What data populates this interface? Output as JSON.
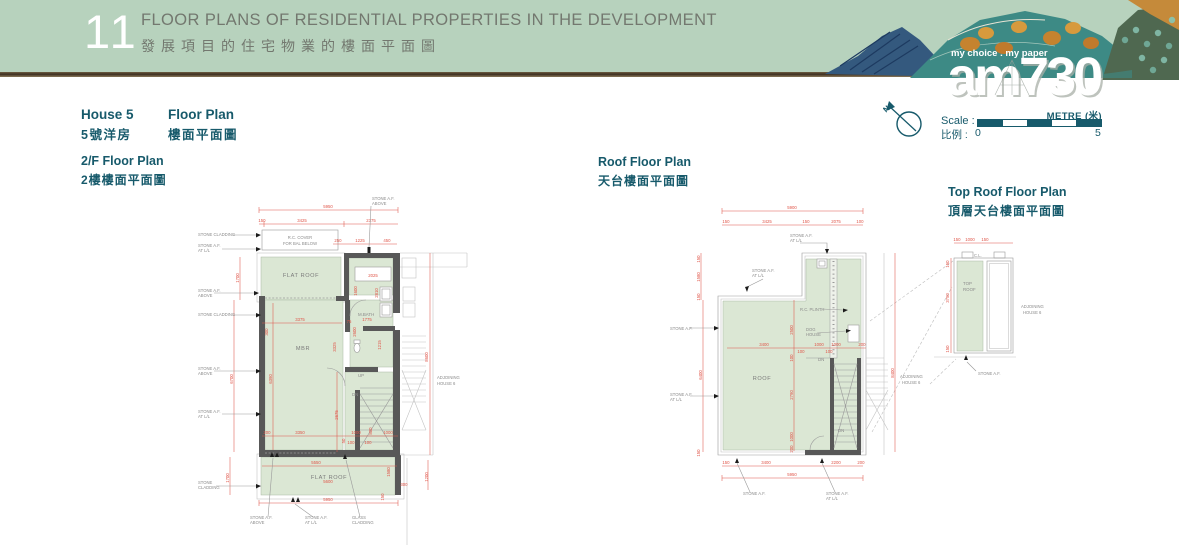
{
  "header": {
    "number": "11",
    "title_en": "FLOOR PLANS OF RESIDENTIAL PROPERTIES IN THE DEVELOPMENT",
    "title_zh": "發展項目的住宅物業的樓面平面圖"
  },
  "masthead": {
    "tagline": "my choice . my paper",
    "logo": "am730"
  },
  "house": {
    "name_en": "House 5",
    "name_zh": "5號洋房",
    "plan_label_en": "Floor Plan",
    "plan_label_zh": "樓面平面圖"
  },
  "scalebar": {
    "metre": "METRE (米)",
    "scale_en": "Scale :",
    "scale_zh": "比例  :",
    "min": "0",
    "max": "5",
    "north": "N",
    "accent": "#175a6b",
    "header_green": "#b7d2bd",
    "dim_red": "#e0564a",
    "plan_green": "#dbe7d4"
  },
  "plans": {
    "f2": {
      "title_en": "2/F Floor Plan",
      "title_zh": "2樓樓面平面圖"
    },
    "roof": {
      "title_en": "Roof Floor Plan",
      "title_zh": "天台樓面平面圖"
    },
    "toproof": {
      "title_en": "Top Roof Floor Plan",
      "title_zh": "頂層天台樓面平面圖"
    }
  },
  "rooms": {
    "flat_roof": "FLAT ROOF",
    "mbr": "MBR",
    "mbath": "M.BATH",
    "roof": "ROOF",
    "top1": "TOP",
    "top2": "ROOF",
    "up": "UP",
    "dn": "DN"
  },
  "notes": {
    "stone_af": "STONE A.F.",
    "above": "ABOVE",
    "at_ll": "AT L/L",
    "stone_cladding": "STONE CLADDING",
    "stone": "STONE",
    "cladding": "CLADDING",
    "glass": "GLASS",
    "adjoining": "ADJOINING",
    "house6": "HOUSE 6",
    "rc_cover1": "R.C. COVER",
    "rc_cover2": "FOR BAL BELOW",
    "rc_plinth": "R.C. PLINTH",
    "dog": "DOG",
    "house": "HOUSE",
    "cl": "C.L."
  },
  "dims": {
    "v50": "50",
    "v75": "75",
    "v100": "100",
    "v150": "150",
    "v200": "200",
    "v250": "250",
    "v300": "300",
    "v450": "450",
    "v800": "800",
    "v1000": "1000",
    "v1200": "1200",
    "v1215": "1215",
    "v1225": "1225",
    "v1580": "1580",
    "v1600": "1600",
    "v1700": "1700",
    "v1775": "1775",
    "v2025": "2025",
    "v2075": "2075",
    "v2200": "2200",
    "v2375": "2375",
    "v2500": "2500",
    "v2600": "2600",
    "v2675": "2675",
    "v2790": "2790",
    "v2810": "2810",
    "v3325": "3325",
    "v3350": "3350",
    "v3375": "3375",
    "v3400": "3400",
    "v3425": "3425",
    "v3750": "3750",
    "v5550": "5550",
    "v5600": "5600",
    "v5900": "5900",
    "v5950": "5950",
    "v6390": "6390",
    "v6400": "6400",
    "v6700": "6700",
    "v8400": "8400",
    "v8600": "8600"
  }
}
